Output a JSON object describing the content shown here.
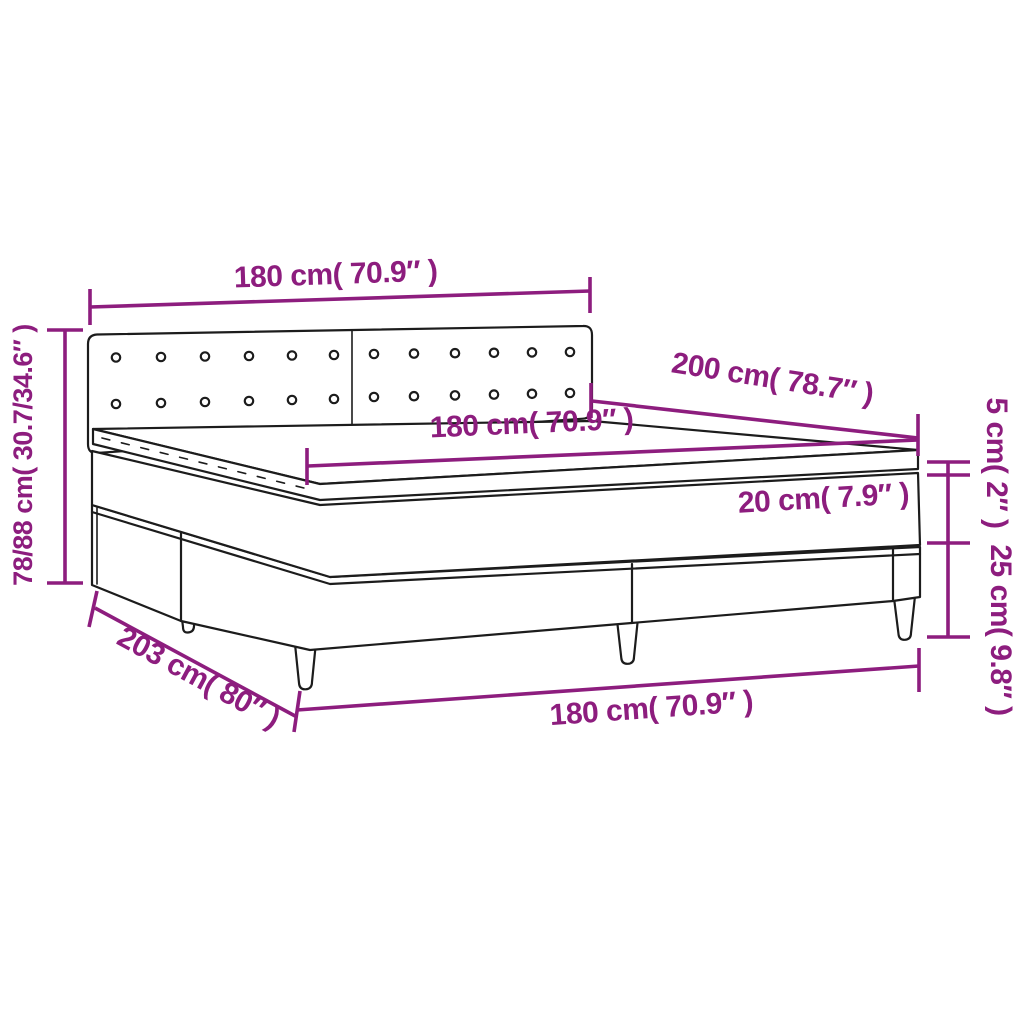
{
  "meta": {
    "title": "Box spring bed with topper dimension diagram",
    "type": "product-dimension-line-drawing"
  },
  "colors": {
    "dimension_color": "#8D1D7E",
    "outline_color": "#1C1C1C",
    "background": "#FFFFFF"
  },
  "labels": {
    "headboard_width": "180 cm( 70.9″ )",
    "bed_length": "200 cm( 78.7″ )",
    "mattress_width": "180 cm( 70.9″ )",
    "mattress_thickness": "20 cm( 7.9″ )",
    "topper_thickness": "5 cm( 2″ )",
    "base_height": "25 cm( 9.8″ )",
    "overall_height": "78/88 cm( 30.7/34.6″ )",
    "base_length": "203 cm( 80″ )",
    "base_width": "180 cm( 70.9″ )"
  }
}
